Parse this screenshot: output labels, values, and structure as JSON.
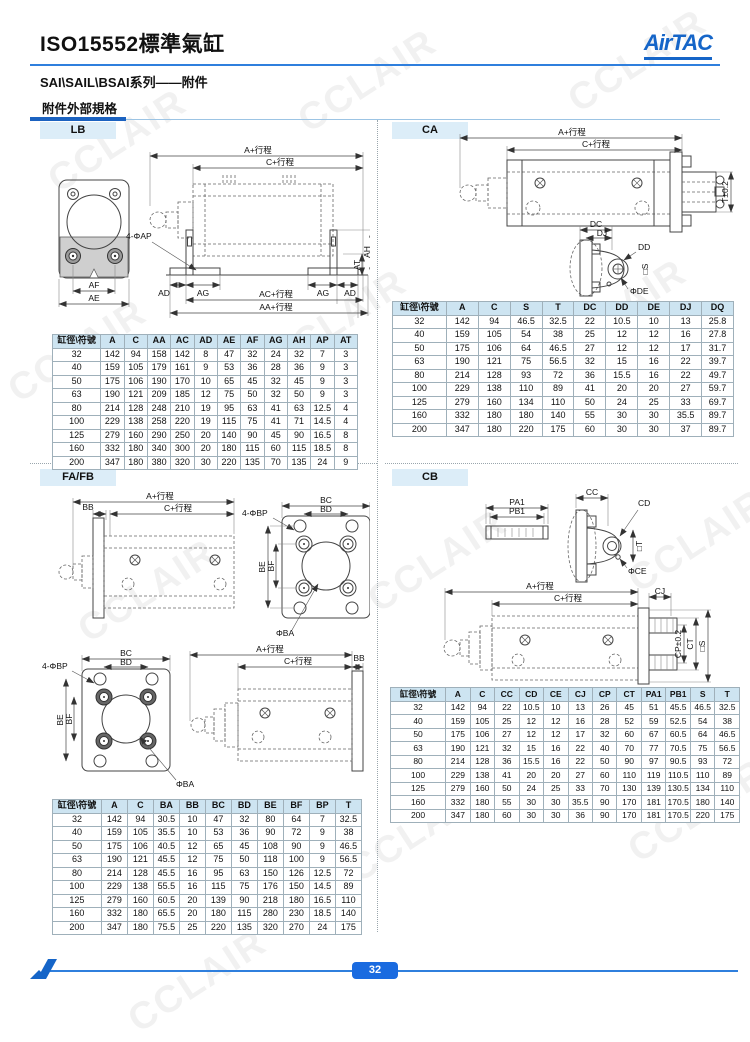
{
  "page": {
    "title": "ISO15552標準氣缸",
    "subtitle": "SAI\\SAIL\\BSAI系列——附件",
    "section_label": "附件外部規格",
    "brand": "AirTAC",
    "page_number": "32",
    "watermark": "CCLAIR",
    "colors": {
      "accent": "#1565c8",
      "table_header_bg": "#cde4f1",
      "badge_bg": "#dcedf8",
      "page_badge": "#1a6be0"
    }
  },
  "drawings": {
    "stroke_a": "A+行程",
    "stroke_c": "C+行程",
    "lb": {
      "ac": "AC+行程",
      "aa": "AA+行程",
      "ad": "AD",
      "ag": "AG",
      "ah": "AH",
      "at": "AT",
      "ap": "4-ΦAP",
      "af": "AF",
      "ae": "AE"
    },
    "ca": {
      "t": "T±0.2",
      "dc": "DC",
      "dj": "DJ",
      "dd": "DD",
      "de": "ΦDE",
      "s": "□S"
    },
    "fafb": {
      "bb": "BB",
      "bp": "4-ΦBP",
      "bc": "BC",
      "bd": "BD",
      "be": "BE",
      "bf": "BF",
      "ba": "ΦBA"
    },
    "cb": {
      "pa1": "PA1",
      "pb1": "PB1",
      "cc": "CC",
      "cd": "CD",
      "ce": "ΦCE",
      "t": "□T",
      "cj": "CJ",
      "cp": "CP±0.2",
      "ct": "CT",
      "s": "□S"
    }
  },
  "sections": {
    "lb": {
      "badge": "LB",
      "table": {
        "headers": [
          "缸徑\\符號",
          "A",
          "C",
          "AA",
          "AC",
          "AD",
          "AE",
          "AF",
          "AG",
          "AH",
          "AP",
          "AT"
        ],
        "rows": [
          [
            "32",
            "142",
            "94",
            "158",
            "142",
            "8",
            "47",
            "32",
            "24",
            "32",
            "7",
            "3"
          ],
          [
            "40",
            "159",
            "105",
            "179",
            "161",
            "9",
            "53",
            "36",
            "28",
            "36",
            "9",
            "3"
          ],
          [
            "50",
            "175",
            "106",
            "190",
            "170",
            "10",
            "65",
            "45",
            "32",
            "45",
            "9",
            "3"
          ],
          [
            "63",
            "190",
            "121",
            "209",
            "185",
            "12",
            "75",
            "50",
            "32",
            "50",
            "9",
            "3"
          ],
          [
            "80",
            "214",
            "128",
            "248",
            "210",
            "19",
            "95",
            "63",
            "41",
            "63",
            "12.5",
            "4"
          ],
          [
            "100",
            "229",
            "138",
            "258",
            "220",
            "19",
            "115",
            "75",
            "41",
            "71",
            "14.5",
            "4"
          ],
          [
            "125",
            "279",
            "160",
            "290",
            "250",
            "20",
            "140",
            "90",
            "45",
            "90",
            "16.5",
            "8"
          ],
          [
            "160",
            "332",
            "180",
            "340",
            "300",
            "20",
            "180",
            "115",
            "60",
            "115",
            "18.5",
            "8"
          ],
          [
            "200",
            "347",
            "180",
            "380",
            "320",
            "30",
            "220",
            "135",
            "70",
            "135",
            "24",
            "9"
          ]
        ]
      }
    },
    "ca": {
      "badge": "CA",
      "table": {
        "headers": [
          "缸徑\\符號",
          "A",
          "C",
          "S",
          "T",
          "DC",
          "DD",
          "DE",
          "DJ",
          "DQ"
        ],
        "rows": [
          [
            "32",
            "142",
            "94",
            "46.5",
            "32.5",
            "22",
            "10.5",
            "10",
            "13",
            "25.8"
          ],
          [
            "40",
            "159",
            "105",
            "54",
            "38",
            "25",
            "12",
            "12",
            "16",
            "27.8"
          ],
          [
            "50",
            "175",
            "106",
            "64",
            "46.5",
            "27",
            "12",
            "12",
            "17",
            "31.7"
          ],
          [
            "63",
            "190",
            "121",
            "75",
            "56.5",
            "32",
            "15",
            "16",
            "22",
            "39.7"
          ],
          [
            "80",
            "214",
            "128",
            "93",
            "72",
            "36",
            "15.5",
            "16",
            "22",
            "49.7"
          ],
          [
            "100",
            "229",
            "138",
            "110",
            "89",
            "41",
            "20",
            "20",
            "27",
            "59.7"
          ],
          [
            "125",
            "279",
            "160",
            "134",
            "110",
            "50",
            "24",
            "25",
            "33",
            "69.7"
          ],
          [
            "160",
            "332",
            "180",
            "180",
            "140",
            "55",
            "30",
            "30",
            "35.5",
            "89.7"
          ],
          [
            "200",
            "347",
            "180",
            "220",
            "175",
            "60",
            "30",
            "30",
            "37",
            "89.7"
          ]
        ]
      }
    },
    "fafb": {
      "badge": "FA/FB",
      "table": {
        "headers": [
          "缸徑\\符號",
          "A",
          "C",
          "BA",
          "BB",
          "BC",
          "BD",
          "BE",
          "BF",
          "BP",
          "T"
        ],
        "rows": [
          [
            "32",
            "142",
            "94",
            "30.5",
            "10",
            "47",
            "32",
            "80",
            "64",
            "7",
            "32.5"
          ],
          [
            "40",
            "159",
            "105",
            "35.5",
            "10",
            "53",
            "36",
            "90",
            "72",
            "9",
            "38"
          ],
          [
            "50",
            "175",
            "106",
            "40.5",
            "12",
            "65",
            "45",
            "108",
            "90",
            "9",
            "46.5"
          ],
          [
            "63",
            "190",
            "121",
            "45.5",
            "12",
            "75",
            "50",
            "118",
            "100",
            "9",
            "56.5"
          ],
          [
            "80",
            "214",
            "128",
            "45.5",
            "16",
            "95",
            "63",
            "150",
            "126",
            "12.5",
            "72"
          ],
          [
            "100",
            "229",
            "138",
            "55.5",
            "16",
            "115",
            "75",
            "176",
            "150",
            "14.5",
            "89"
          ],
          [
            "125",
            "279",
            "160",
            "60.5",
            "20",
            "139",
            "90",
            "218",
            "180",
            "16.5",
            "110"
          ],
          [
            "160",
            "332",
            "180",
            "65.5",
            "20",
            "180",
            "115",
            "280",
            "230",
            "18.5",
            "140"
          ],
          [
            "200",
            "347",
            "180",
            "75.5",
            "25",
            "220",
            "135",
            "320",
            "270",
            "24",
            "175"
          ]
        ]
      }
    },
    "cb": {
      "badge": "CB",
      "table": {
        "headers": [
          "缸徑\\符號",
          "A",
          "C",
          "CC",
          "CD",
          "CE",
          "CJ",
          "CP",
          "CT",
          "PA1",
          "PB1",
          "S",
          "T"
        ],
        "rows": [
          [
            "32",
            "142",
            "94",
            "22",
            "10.5",
            "10",
            "13",
            "26",
            "45",
            "51",
            "45.5",
            "46.5",
            "32.5"
          ],
          [
            "40",
            "159",
            "105",
            "25",
            "12",
            "12",
            "16",
            "28",
            "52",
            "59",
            "52.5",
            "54",
            "38"
          ],
          [
            "50",
            "175",
            "106",
            "27",
            "12",
            "12",
            "17",
            "32",
            "60",
            "67",
            "60.5",
            "64",
            "46.5"
          ],
          [
            "63",
            "190",
            "121",
            "32",
            "15",
            "16",
            "22",
            "40",
            "70",
            "77",
            "70.5",
            "75",
            "56.5"
          ],
          [
            "80",
            "214",
            "128",
            "36",
            "15.5",
            "16",
            "22",
            "50",
            "90",
            "97",
            "90.5",
            "93",
            "72"
          ],
          [
            "100",
            "229",
            "138",
            "41",
            "20",
            "20",
            "27",
            "60",
            "110",
            "119",
            "110.5",
            "110",
            "89"
          ],
          [
            "125",
            "279",
            "160",
            "50",
            "24",
            "25",
            "33",
            "70",
            "130",
            "139",
            "130.5",
            "134",
            "110"
          ],
          [
            "160",
            "332",
            "180",
            "55",
            "30",
            "30",
            "35.5",
            "90",
            "170",
            "181",
            "170.5",
            "180",
            "140"
          ],
          [
            "200",
            "347",
            "180",
            "60",
            "30",
            "30",
            "36",
            "90",
            "170",
            "181",
            "170.5",
            "220",
            "175"
          ]
        ]
      }
    }
  }
}
